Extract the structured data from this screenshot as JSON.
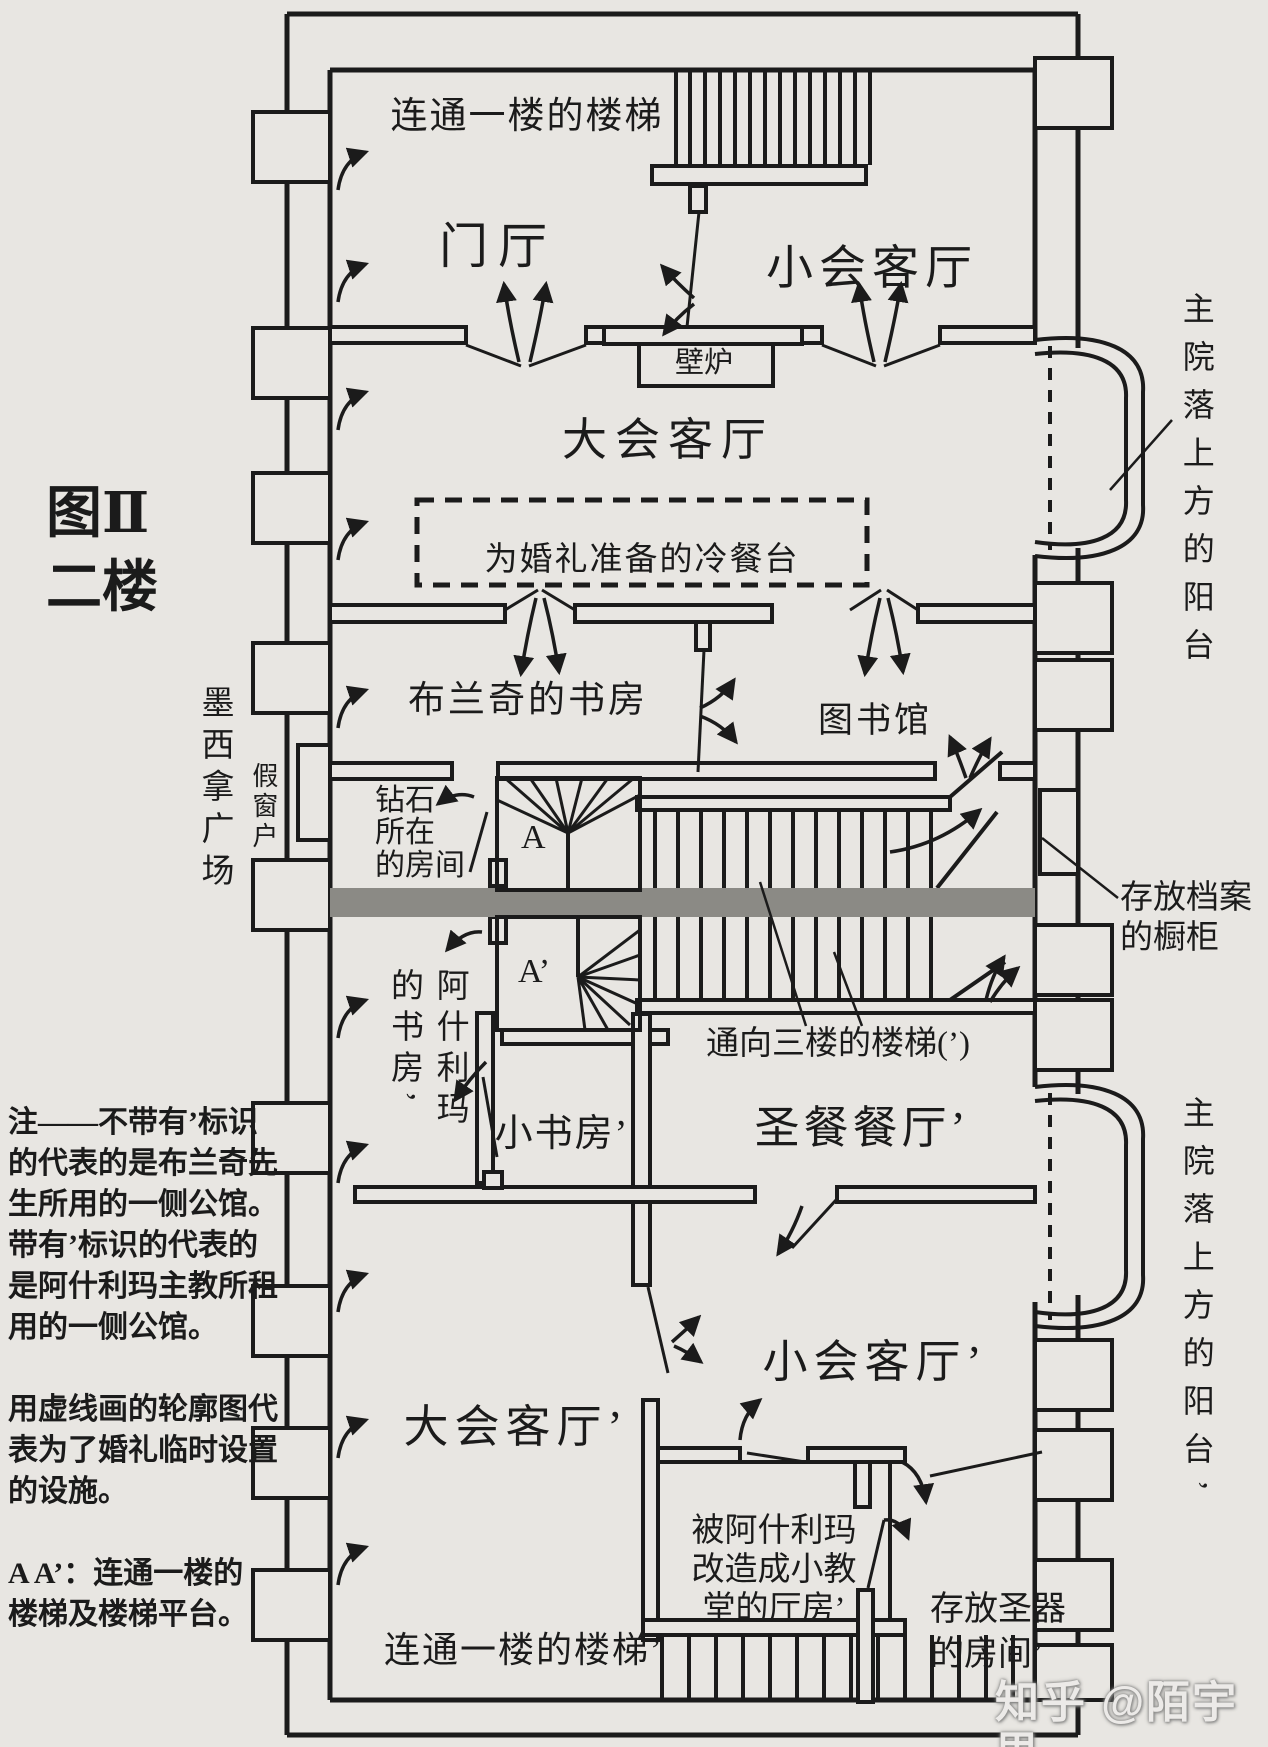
{
  "figure": {
    "title": "图Ⅱ\n二楼"
  },
  "rooms": {
    "entrance_hall": "门厅",
    "small_parlor": "小会客厅",
    "grand_parlor": "大会客厅",
    "blanche_study": "布兰奇的书房",
    "library": "图书馆",
    "diamond_room": "钻石\n所在\n的房间",
    "ashlima_study": "阿什利玛\n的书房’",
    "small_study": "小书房’",
    "communion_dining": "圣餐餐厅’",
    "small_parlor_prime": "小会客厅’",
    "grand_parlor_prime": "大会客厅’",
    "chapel": "被阿什利玛\n改造成小教\n堂的厅房’",
    "sacristy": "存放圣器\n的房间’"
  },
  "stairs": {
    "to_first_top": "连通一楼的楼梯",
    "to_first_bottom": "连通一楼的楼梯’",
    "to_third": "通向三楼的楼梯(’)",
    "landing_a": "A",
    "landing_a_prime": "A’"
  },
  "features": {
    "fireplace": "壁炉",
    "wedding_buffet": "为婚礼准备的冷餐台",
    "archive_cabinet": "存放档案\n的橱柜",
    "fake_window": "假窗户",
    "messina_square": "墨西拿广场",
    "balcony_top": "主院落上方的阳台",
    "balcony_bottom": "主院落上方的阳台’"
  },
  "note": {
    "text": "注——不带有’标识\n的代表的是布兰奇先\n生所用的一侧公馆。\n带有’标识的代表的\n是阿什利玛主教所租\n用的一侧公馆。\n\n用虚线画的轮廓图代\n表为了婚礼临时设置\n的设施。\n\nA A’：连通一楼的\n楼梯及楼梯平台。"
  },
  "watermark": {
    "text": "知乎 @陌宇思"
  },
  "colors": {
    "ink": "#1b1b1b",
    "paper": "#e8e6e2",
    "band": "#8b8a85"
  }
}
